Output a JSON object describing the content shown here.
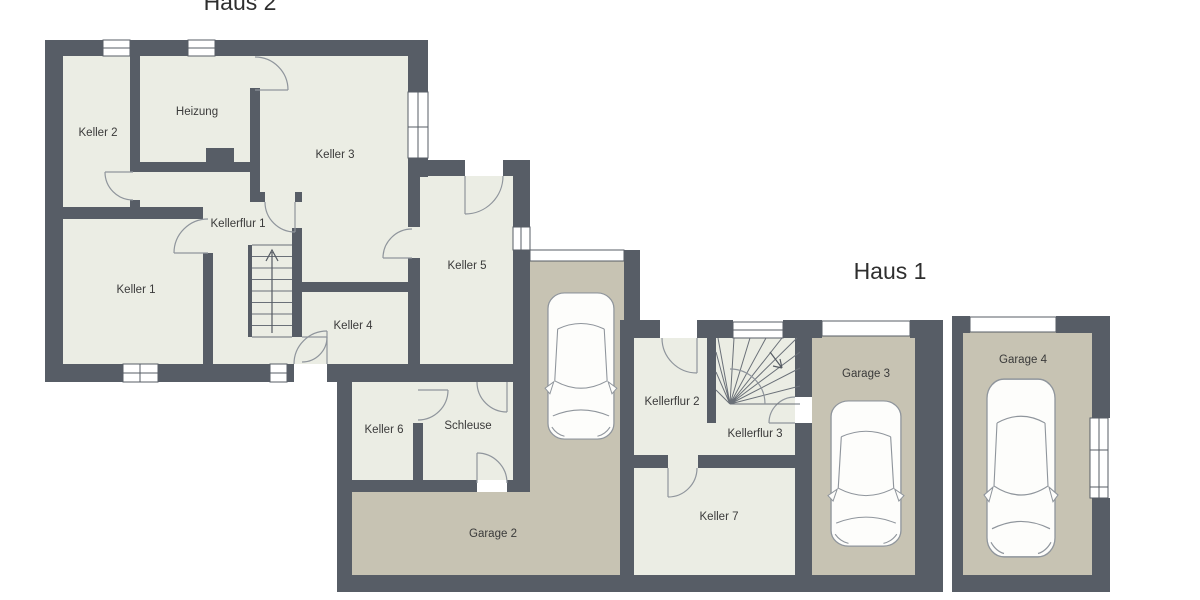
{
  "plan": {
    "haus2_title": "Haus 2",
    "haus1_title": "Haus 1"
  },
  "rooms": {
    "keller1": "Keller 1",
    "keller2": "Keller 2",
    "heizung": "Heizung",
    "keller3": "Keller 3",
    "kellerflur1": "Kellerflur 1",
    "keller4": "Keller 4",
    "keller5": "Keller 5",
    "keller6": "Keller 6",
    "schleuse": "Schleuse",
    "garage2": "Garage 2",
    "kellerflur2": "Kellerflur 2",
    "kellerflur3": "Kellerflur 3",
    "keller7": "Keller 7",
    "garage3": "Garage 3",
    "garage4": "Garage 4"
  },
  "colors": {
    "background": "#ffffff",
    "wall": "#575d66",
    "room": "#ebede4",
    "garage": "#c7c3b3",
    "line": "#8f959c",
    "label": "#3a3a3a"
  }
}
